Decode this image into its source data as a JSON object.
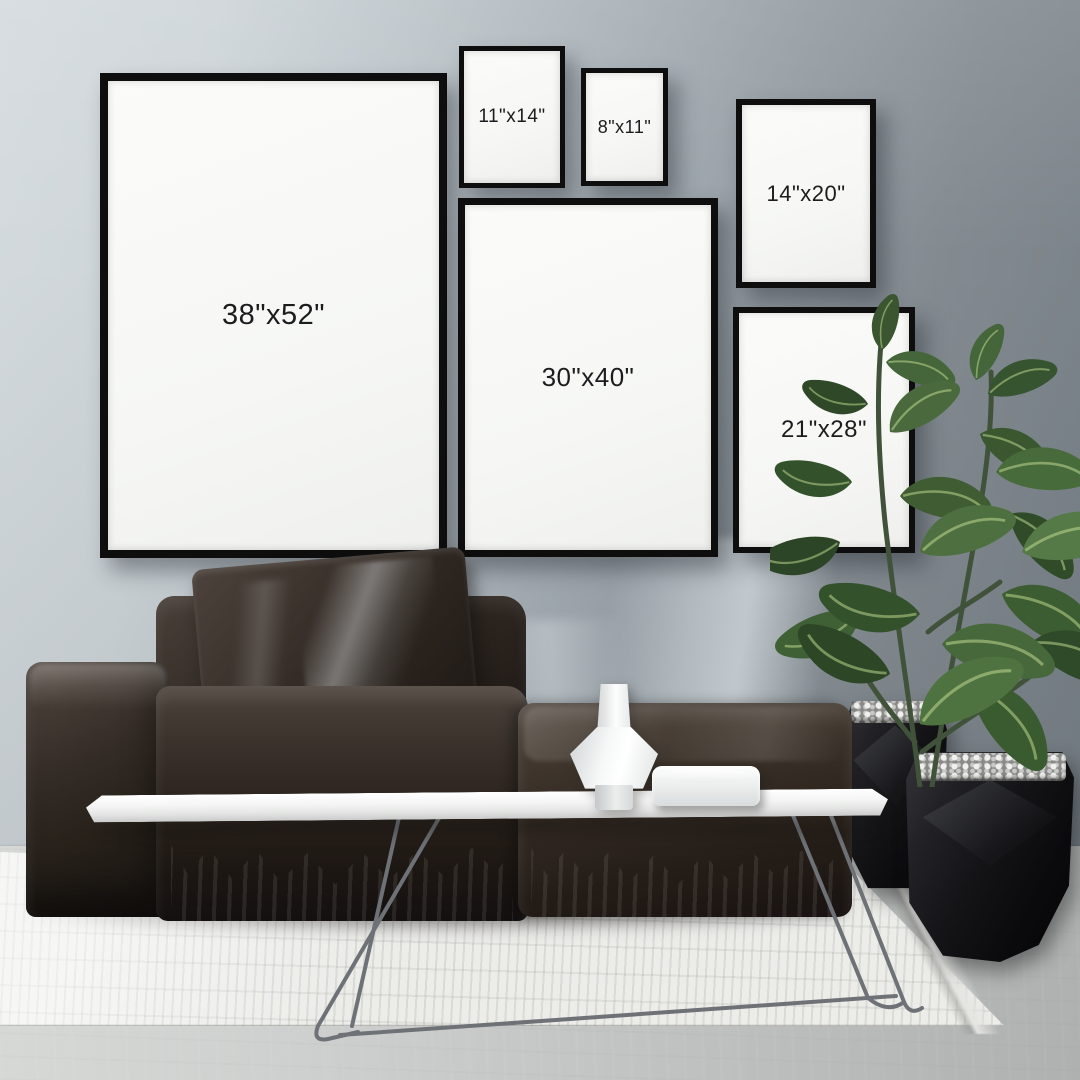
{
  "frames": [
    {
      "id": "38x52",
      "label": "38\"x52\""
    },
    {
      "id": "11x14",
      "label": "11\"x14\""
    },
    {
      "id": "8x11",
      "label": "8\"x11\""
    },
    {
      "id": "14x20",
      "label": "14\"x20\""
    },
    {
      "id": "30x40",
      "label": "30\"x40\""
    },
    {
      "id": "21x28",
      "label": "21\"x28\""
    }
  ],
  "colors": {
    "wall_light": "#d4dade",
    "wall_dark": "#778086",
    "frame_border": "#0e0e0f",
    "frame_matte": "#f8f9f7",
    "label_text": "#1c1c1e",
    "sofa_dark": "#1d1713",
    "sofa_light": "#5a5049",
    "table_top": "#f6f6f5",
    "metal_leg": "#6e7276",
    "rug": "#ecece9",
    "floor": "#c6c9c8",
    "plant_green": "#3f5c33",
    "planter_black": "#121214",
    "ceramic_white": "#f0f1f1"
  }
}
